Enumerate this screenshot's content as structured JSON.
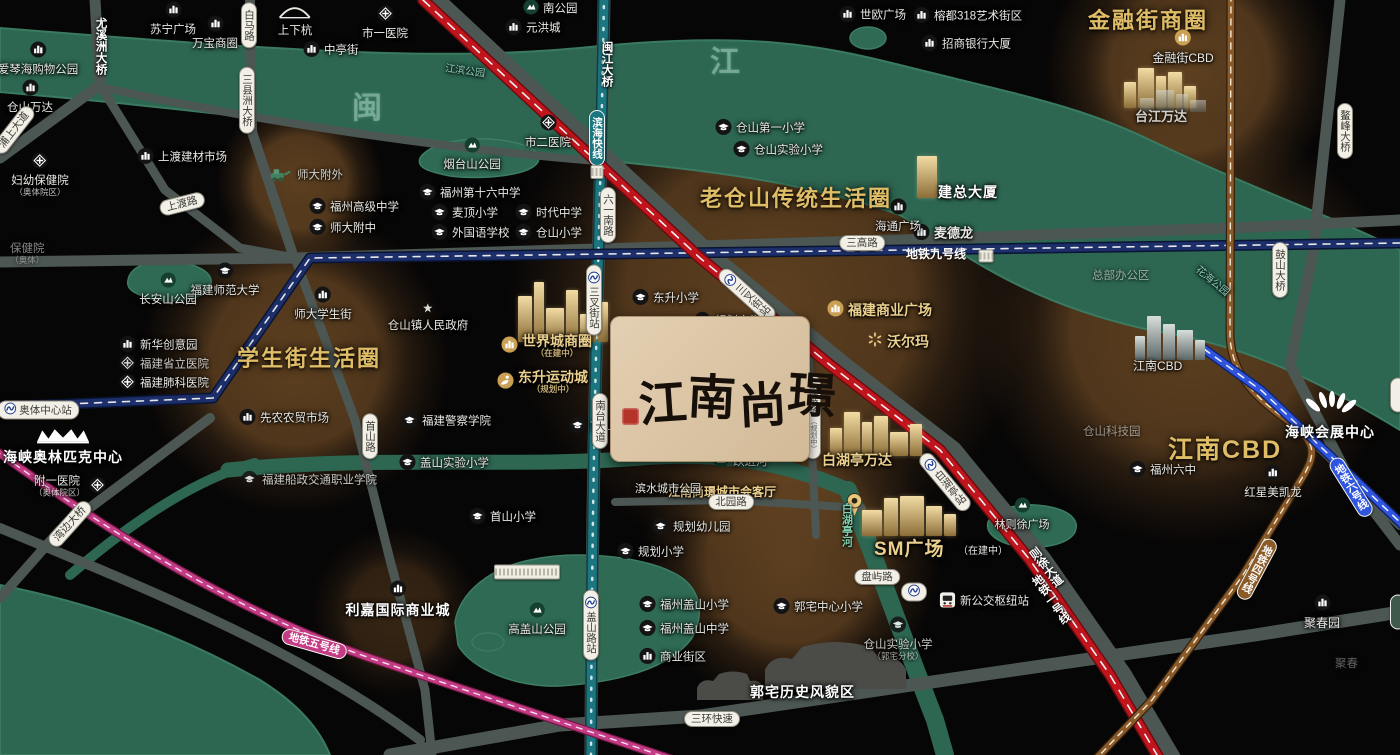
{
  "logo": {
    "name": "江南尚璟"
  },
  "colors": {
    "background": "#070606",
    "river": "#2d6752",
    "road": "#4c5652",
    "halo": "#92632f",
    "gold_title": "#dfbc66",
    "metro_line1_red": "#c0151c",
    "metro_line4_bronze": "#8a5a28",
    "metro_line5_magenta": "#c43b86",
    "metro_line6_blue": "#2f55e0",
    "metro_line9_navy": "#1d2f6b",
    "coastal_teal": "#1b7680"
  },
  "pois": [
    {
      "x": 38,
      "y": 50,
      "k": "biz",
      "t": "爱琴海购物公园",
      "lp": "b"
    },
    {
      "x": 173,
      "y": 10,
      "k": "biz",
      "t": "苏宁广场",
      "lp": "b"
    },
    {
      "x": 215,
      "y": 24,
      "k": "biz",
      "t": "万宝商圈",
      "lp": "b"
    },
    {
      "x": 295,
      "y": 14,
      "k": "bridge",
      "t": "上下杭",
      "lp": "b"
    },
    {
      "x": 312,
      "y": 51,
      "k": "biz",
      "t": "中亭街",
      "lp": "r"
    },
    {
      "x": 30,
      "y": 88,
      "k": "biz",
      "t": "仓山万达",
      "lp": "b"
    },
    {
      "x": 146,
      "y": 158,
      "k": "biz",
      "t": "上渡建材市场",
      "lp": "r"
    },
    {
      "x": 40,
      "y": 161,
      "k": "med",
      "t": "妇幼保健院",
      "lp": "b",
      "s": "（奥体院区）"
    },
    {
      "x": 10,
      "y": 243,
      "k": "none",
      "t": "保健院",
      "s": "（奥体）",
      "c": "faint",
      "lp": "t"
    },
    {
      "x": 385,
      "y": 14,
      "k": "med",
      "t": "市一医院",
      "lp": "b"
    },
    {
      "x": 532,
      "y": 9,
      "k": "park",
      "t": "南公园",
      "lp": "r"
    },
    {
      "x": 514,
      "y": 29,
      "k": "biz",
      "t": "元洪城",
      "lp": "r"
    },
    {
      "x": 848,
      "y": 16,
      "k": "biz",
      "t": "世欧广场",
      "lp": "r"
    },
    {
      "x": 922,
      "y": 17,
      "k": "biz",
      "t": "榕都318艺术街区",
      "lp": "r"
    },
    {
      "x": 930,
      "y": 45,
      "k": "biz",
      "t": "招商银行大厦",
      "lp": "r"
    },
    {
      "x": 548,
      "y": 123,
      "k": "med",
      "t": "市二医院",
      "lp": "b"
    },
    {
      "x": 472,
      "y": 146,
      "k": "park",
      "t": "烟台山公园",
      "lp": "b"
    },
    {
      "x": 445,
      "y": 66,
      "k": "none",
      "t": "江滨公园",
      "c": "teal",
      "lp": "t",
      "r": 8
    },
    {
      "x": 1192,
      "y": 276,
      "k": "none",
      "t": "花海公园",
      "c": "teal",
      "lp": "t",
      "r": 40
    },
    {
      "x": 428,
      "y": 194,
      "k": "sch",
      "t": "福州第十六中学",
      "lp": "r"
    },
    {
      "x": 440,
      "y": 214,
      "k": "sch",
      "t": "麦顶小学",
      "lp": "r"
    },
    {
      "x": 524,
      "y": 214,
      "k": "sch",
      "t": "时代中学",
      "lp": "r"
    },
    {
      "x": 440,
      "y": 234,
      "k": "sch",
      "t": "外国语学校",
      "lp": "r"
    },
    {
      "x": 524,
      "y": 234,
      "k": "sch",
      "t": "仓山小学",
      "lp": "r"
    },
    {
      "x": 318,
      "y": 208,
      "k": "sch",
      "t": "福州高级中学",
      "lp": "r"
    },
    {
      "x": 318,
      "y": 229,
      "k": "sch",
      "t": "师大附中",
      "lp": "r"
    },
    {
      "x": 278,
      "y": 176,
      "k": "tractor",
      "t": "师大附外",
      "lp": "r",
      "c": "faint2"
    },
    {
      "x": 225,
      "y": 271,
      "k": "sch",
      "t": "福建师范大学",
      "lp": "b"
    },
    {
      "x": 323,
      "y": 295,
      "k": "biz",
      "t": "师大学生街",
      "lp": "b"
    },
    {
      "x": 168,
      "y": 281,
      "k": "park",
      "t": "长安山公园",
      "lp": "b"
    },
    {
      "x": 128,
      "y": 346,
      "k": "biz",
      "t": "新华创意园",
      "lp": "r"
    },
    {
      "x": 128,
      "y": 365,
      "k": "med",
      "t": "福建省立医院",
      "lp": "r",
      "c": "faint2"
    },
    {
      "x": 128,
      "y": 384,
      "k": "med",
      "t": "福建肺科医院",
      "lp": "r"
    },
    {
      "x": 63,
      "y": 436,
      "k": "crown",
      "t": "海峡奥林匹克中心",
      "lp": "b",
      "c": "bw14"
    },
    {
      "x": 97,
      "y": 487,
      "k": "med",
      "t": "附一医院",
      "lp": "l",
      "s": "（奥体院区）"
    },
    {
      "x": 410,
      "y": 422,
      "k": "sch",
      "t": "福建警察学院",
      "lp": "r"
    },
    {
      "x": 248,
      "y": 419,
      "k": "biz",
      "t": "先农农贸市场",
      "lp": "r"
    },
    {
      "x": 250,
      "y": 481,
      "k": "sch",
      "t": "福建船政交通职业学院",
      "lp": "r",
      "c": "faint2"
    },
    {
      "x": 428,
      "y": 311,
      "k": "star",
      "t": "仓山镇人民政府",
      "lp": "b"
    },
    {
      "x": 510,
      "y": 346,
      "k": "gold",
      "t": "世界城商圈",
      "lp": "r",
      "c": "goldb",
      "s": "（在建中）"
    },
    {
      "x": 506,
      "y": 382,
      "k": "sport",
      "t": "东升运动城",
      "lp": "r",
      "c": "goldb",
      "s": "（规划中）"
    },
    {
      "x": 578,
      "y": 427,
      "k": "sch",
      "t": "首山中学",
      "lp": "r"
    },
    {
      "x": 408,
      "y": 464,
      "k": "sch",
      "t": "盖山实验小学",
      "lp": "r"
    },
    {
      "x": 641,
      "y": 299,
      "k": "sch",
      "t": "东升小学",
      "lp": "r"
    },
    {
      "x": 703,
      "y": 322,
      "k": "sch",
      "t": "规划中学",
      "lp": "r"
    },
    {
      "x": 626,
      "y": 553,
      "k": "sch",
      "t": "规划小学",
      "lp": "r"
    },
    {
      "x": 661,
      "y": 528,
      "k": "sch",
      "t": "规划幼儿园",
      "lp": "r"
    },
    {
      "x": 478,
      "y": 518,
      "k": "sch",
      "t": "首山小学",
      "lp": "r"
    },
    {
      "x": 537,
      "y": 611,
      "k": "park",
      "t": "高盖山公园",
      "lp": "b"
    },
    {
      "x": 398,
      "y": 589,
      "k": "biz",
      "t": "利嘉国际商业城",
      "lp": "b",
      "c": "bw14"
    },
    {
      "x": 648,
      "y": 606,
      "k": "sch",
      "t": "福州盖山小学",
      "lp": "r"
    },
    {
      "x": 648,
      "y": 630,
      "k": "sch",
      "t": "福州盖山中学",
      "lp": "r"
    },
    {
      "x": 648,
      "y": 658,
      "k": "biz",
      "t": "商业街区",
      "lp": "r"
    },
    {
      "x": 782,
      "y": 608,
      "k": "sch",
      "t": "郭宅中心小学",
      "lp": "r"
    },
    {
      "x": 898,
      "y": 625,
      "k": "sch",
      "t": "仓山实验小学",
      "lp": "b",
      "s": "（郭宅分校）",
      "c": "faint2"
    },
    {
      "x": 750,
      "y": 684,
      "k": "none",
      "t": "郭宅历史风貌区",
      "lp": "t",
      "c": "bw14"
    },
    {
      "x": 948,
      "y": 602,
      "k": "bus",
      "t": "新公交枢纽站",
      "lp": "r"
    },
    {
      "x": 722,
      "y": 462,
      "k": "park",
      "t": "跃进河",
      "lp": "r"
    },
    {
      "x": 668,
      "y": 486,
      "k": "none",
      "t": "江南尚璟城市会客厅",
      "c": "goldb g12",
      "lp": "t"
    },
    {
      "x": 845,
      "y": 492,
      "k": "pin",
      "t": "",
      "lp": "t"
    },
    {
      "x": 635,
      "y": 483,
      "k": "none",
      "t": "滨水城市公园",
      "c": "w11",
      "lp": "t"
    },
    {
      "x": 822,
      "y": 452,
      "k": "none",
      "t": "白湖亭万达",
      "c": "goldb g14",
      "lp": "t"
    },
    {
      "x": 836,
      "y": 310,
      "k": "gold",
      "t": "福建商业广场",
      "lp": "r",
      "c": "goldb g14"
    },
    {
      "x": 876,
      "y": 341,
      "k": "wal",
      "t": "沃尔玛",
      "lp": "r",
      "c": "goldb g14"
    },
    {
      "x": 874,
      "y": 539,
      "k": "none",
      "t": "SM广场",
      "c": "goldb g18",
      "lp": "t"
    },
    {
      "x": 958,
      "y": 546,
      "k": "none",
      "t": "（在建中）",
      "c": "w10",
      "lp": "t"
    },
    {
      "x": 1022,
      "y": 506,
      "k": "park",
      "t": "林则徐广场",
      "lp": "b",
      "c": "w11"
    },
    {
      "x": 1138,
      "y": 471,
      "k": "sch",
      "t": "福州六中",
      "lp": "r"
    },
    {
      "x": 1083,
      "y": 426,
      "k": "none",
      "t": "仓山科技园",
      "c": "faint",
      "lp": "t"
    },
    {
      "x": 1092,
      "y": 270,
      "k": "none",
      "t": "总部办公区",
      "c": "faint",
      "lp": "t"
    },
    {
      "x": 1133,
      "y": 360,
      "k": "none",
      "t": "江南CBD",
      "c": "w12",
      "lp": "t"
    },
    {
      "x": 1168,
      "y": 436,
      "k": "none",
      "t": "江南CBD",
      "c": "goldbig g24",
      "lp": "t"
    },
    {
      "x": 1273,
      "y": 473,
      "k": "biz",
      "t": "红星美凯龙",
      "lp": "b"
    },
    {
      "x": 1330,
      "y": 400,
      "k": "fan",
      "t": "海峡会展中心",
      "lp": "b",
      "c": "bw14"
    },
    {
      "x": 1088,
      "y": 8,
      "k": "none",
      "t": "金融街商圈",
      "c": "goldbig",
      "lp": "t"
    },
    {
      "x": 1183,
      "y": 38,
      "k": "gold",
      "t": "金融街CBD",
      "lp": "b",
      "c": "w12"
    },
    {
      "x": 1135,
      "y": 110,
      "k": "none",
      "t": "台江万达",
      "c": "w13 o85",
      "lp": "t"
    },
    {
      "x": 938,
      "y": 184,
      "k": "none",
      "t": "建总大厦",
      "c": "bw14",
      "lp": "t"
    },
    {
      "x": 922,
      "y": 234,
      "k": "biz",
      "t": "麦德龙",
      "lp": "r",
      "c": "w13"
    },
    {
      "x": 898,
      "y": 207,
      "k": "biz",
      "t": "海通广场",
      "lp": "b"
    },
    {
      "x": 700,
      "y": 186,
      "k": "none",
      "t": "老仓山传统生活圈",
      "c": "goldbig",
      "lp": "t"
    },
    {
      "x": 237,
      "y": 346,
      "k": "none",
      "t": "学生街生活圈",
      "c": "goldbig",
      "lp": "t"
    },
    {
      "x": 724,
      "y": 129,
      "k": "sch",
      "t": "仓山第一小学",
      "lp": "r"
    },
    {
      "x": 742,
      "y": 151,
      "k": "sch",
      "t": "仓山实验小学",
      "lp": "r"
    },
    {
      "x": 1322,
      "y": 603,
      "k": "biz",
      "t": "聚春园",
      "lp": "b",
      "c": "w12"
    },
    {
      "x": 1335,
      "y": 658,
      "k": "none",
      "t": "聚春",
      "c": "faint o45",
      "lp": "t"
    },
    {
      "x": 352,
      "y": 92,
      "k": "none",
      "t": "闽",
      "c": "riverchar",
      "lp": "t"
    },
    {
      "x": 710,
      "y": 46,
      "k": "none",
      "t": "江",
      "c": "riverchar",
      "lp": "t"
    }
  ],
  "badges": [
    {
      "x": 249,
      "y": 25,
      "t": "白马路",
      "v": 1
    },
    {
      "x": 247,
      "y": 100,
      "t": "三县洲大桥",
      "v": 1
    },
    {
      "x": 100,
      "y": 46,
      "t": "尤溪洲大桥",
      "v": 1,
      "k": "plain"
    },
    {
      "x": 606,
      "y": 64,
      "t": "闽江大桥",
      "v": 1,
      "k": "plain"
    },
    {
      "x": 14,
      "y": 130,
      "t": "浦上大道",
      "r": -52
    },
    {
      "x": 182,
      "y": 204,
      "t": "上渡路",
      "r": -14
    },
    {
      "x": 597,
      "y": 138,
      "t": "滨海快线",
      "v": 1,
      "k": "line",
      "bg": "#1b7680"
    },
    {
      "x": 597,
      "y": 172,
      "k": "smudge",
      "w": 11,
      "h": 12
    },
    {
      "x": 608,
      "y": 215,
      "t": "六一南路",
      "v": 1
    },
    {
      "x": 862,
      "y": 243,
      "t": "三高路"
    },
    {
      "x": 936,
      "y": 255,
      "t": "地铁九号线",
      "k": "plainline"
    },
    {
      "x": 986,
      "y": 256,
      "k": "smudge",
      "w": 13,
      "h": 11
    },
    {
      "x": 1280,
      "y": 270,
      "t": "鼓山大桥",
      "v": 1
    },
    {
      "x": 1345,
      "y": 131,
      "t": "鳌峰大桥",
      "v": 1
    },
    {
      "x": 722,
      "y": 348,
      "t": "东园路",
      "s": "（规划中）"
    },
    {
      "x": 813,
      "y": 417,
      "t": "东滨路",
      "v": 1,
      "s": "（规划中）"
    },
    {
      "x": 600,
      "y": 421,
      "t": "南台大道",
      "v": 1
    },
    {
      "x": 370,
      "y": 436,
      "t": "首山路",
      "v": 1
    },
    {
      "x": 731,
      "y": 502,
      "t": "北园路"
    },
    {
      "x": 877,
      "y": 577,
      "t": "盘屿路"
    },
    {
      "x": 527,
      "y": 572,
      "k": "smudge",
      "w": 64,
      "h": 13
    },
    {
      "x": 914,
      "y": 592,
      "k": "mini"
    },
    {
      "x": 594,
      "y": 300,
      "t": "三叉街站",
      "v": 1,
      "k": "station"
    },
    {
      "x": 591,
      "y": 625,
      "t": "盖山路站",
      "v": 1,
      "k": "station"
    },
    {
      "x": 747,
      "y": 295,
      "t": "三叉街站",
      "v": 1,
      "k": "station",
      "r": -48
    },
    {
      "x": 945,
      "y": 482,
      "t": "白湖亭站",
      "v": 1,
      "k": "station",
      "r": -40
    },
    {
      "x": 1050,
      "y": 600,
      "t": "地铁一号线",
      "v": 1,
      "k": "plain",
      "r": -35
    },
    {
      "x": 1045,
      "y": 568,
      "t": "则徐大道",
      "v": 1,
      "k": "plain",
      "r": -38
    },
    {
      "x": 1257,
      "y": 569,
      "t": "地铁四号线",
      "v": 1,
      "k": "line",
      "bg": "#8a5a28",
      "r": 28
    },
    {
      "x": 1351,
      "y": 487,
      "t": "地铁六号线",
      "v": 1,
      "k": "line",
      "bg": "#2f55e0",
      "r": -32
    },
    {
      "x": 314,
      "y": 644,
      "t": "地铁五号线",
      "k": "line",
      "bg": "#c43b86",
      "r": 16
    },
    {
      "x": 38,
      "y": 410,
      "t": "奥体中心站",
      "k": "station"
    },
    {
      "x": 70,
      "y": 524,
      "t": "湾边大桥",
      "r": -48
    },
    {
      "x": 712,
      "y": 719,
      "t": "三环快速"
    },
    {
      "x": 846,
      "y": 525,
      "t": "白湖亭河",
      "v": 1,
      "k": "plain",
      "c": "river-lb"
    },
    {
      "x": 1398,
      "y": 395,
      "t": "　　",
      "v": 1
    },
    {
      "x": 1398,
      "y": 612,
      "t": "　　",
      "v": 1,
      "k": "line",
      "bg": "#3f5a4c"
    }
  ],
  "buildings": [
    {
      "x": 518,
      "y": 278,
      "h": 64,
      "c": "gold",
      "bars": [
        [
          14,
          46
        ],
        [
          10,
          60
        ],
        [
          18,
          34
        ],
        [
          12,
          52
        ],
        [
          16,
          28
        ],
        [
          10,
          40
        ]
      ]
    },
    {
      "x": 830,
      "y": 412,
      "h": 44,
      "c": "gold",
      "bars": [
        [
          12,
          28
        ],
        [
          16,
          44
        ],
        [
          10,
          34
        ],
        [
          14,
          40
        ],
        [
          18,
          24
        ],
        [
          12,
          32
        ]
      ]
    },
    {
      "x": 862,
      "y": 496,
      "h": 40,
      "c": "gold",
      "bars": [
        [
          20,
          26
        ],
        [
          14,
          38
        ],
        [
          24,
          40
        ],
        [
          16,
          30
        ],
        [
          12,
          22
        ]
      ]
    },
    {
      "x": 917,
      "y": 156,
      "h": 42,
      "c": "gold",
      "bars": [
        [
          20,
          42
        ]
      ]
    },
    {
      "x": 1124,
      "y": 68,
      "h": 40,
      "c": "gold",
      "bars": [
        [
          12,
          26
        ],
        [
          16,
          40
        ],
        [
          10,
          32
        ],
        [
          14,
          36
        ],
        [
          12,
          22
        ]
      ]
    },
    {
      "x": 1135,
      "y": 316,
      "h": 44,
      "c": "grey",
      "bars": [
        [
          10,
          24
        ],
        [
          14,
          44
        ],
        [
          12,
          36
        ],
        [
          16,
          30
        ],
        [
          10,
          20
        ]
      ]
    },
    {
      "x": 1140,
      "y": 90,
      "h": 22,
      "c": "grey dim",
      "bars": [
        [
          14,
          14
        ],
        [
          18,
          22
        ],
        [
          12,
          18
        ],
        [
          16,
          12
        ]
      ]
    }
  ]
}
